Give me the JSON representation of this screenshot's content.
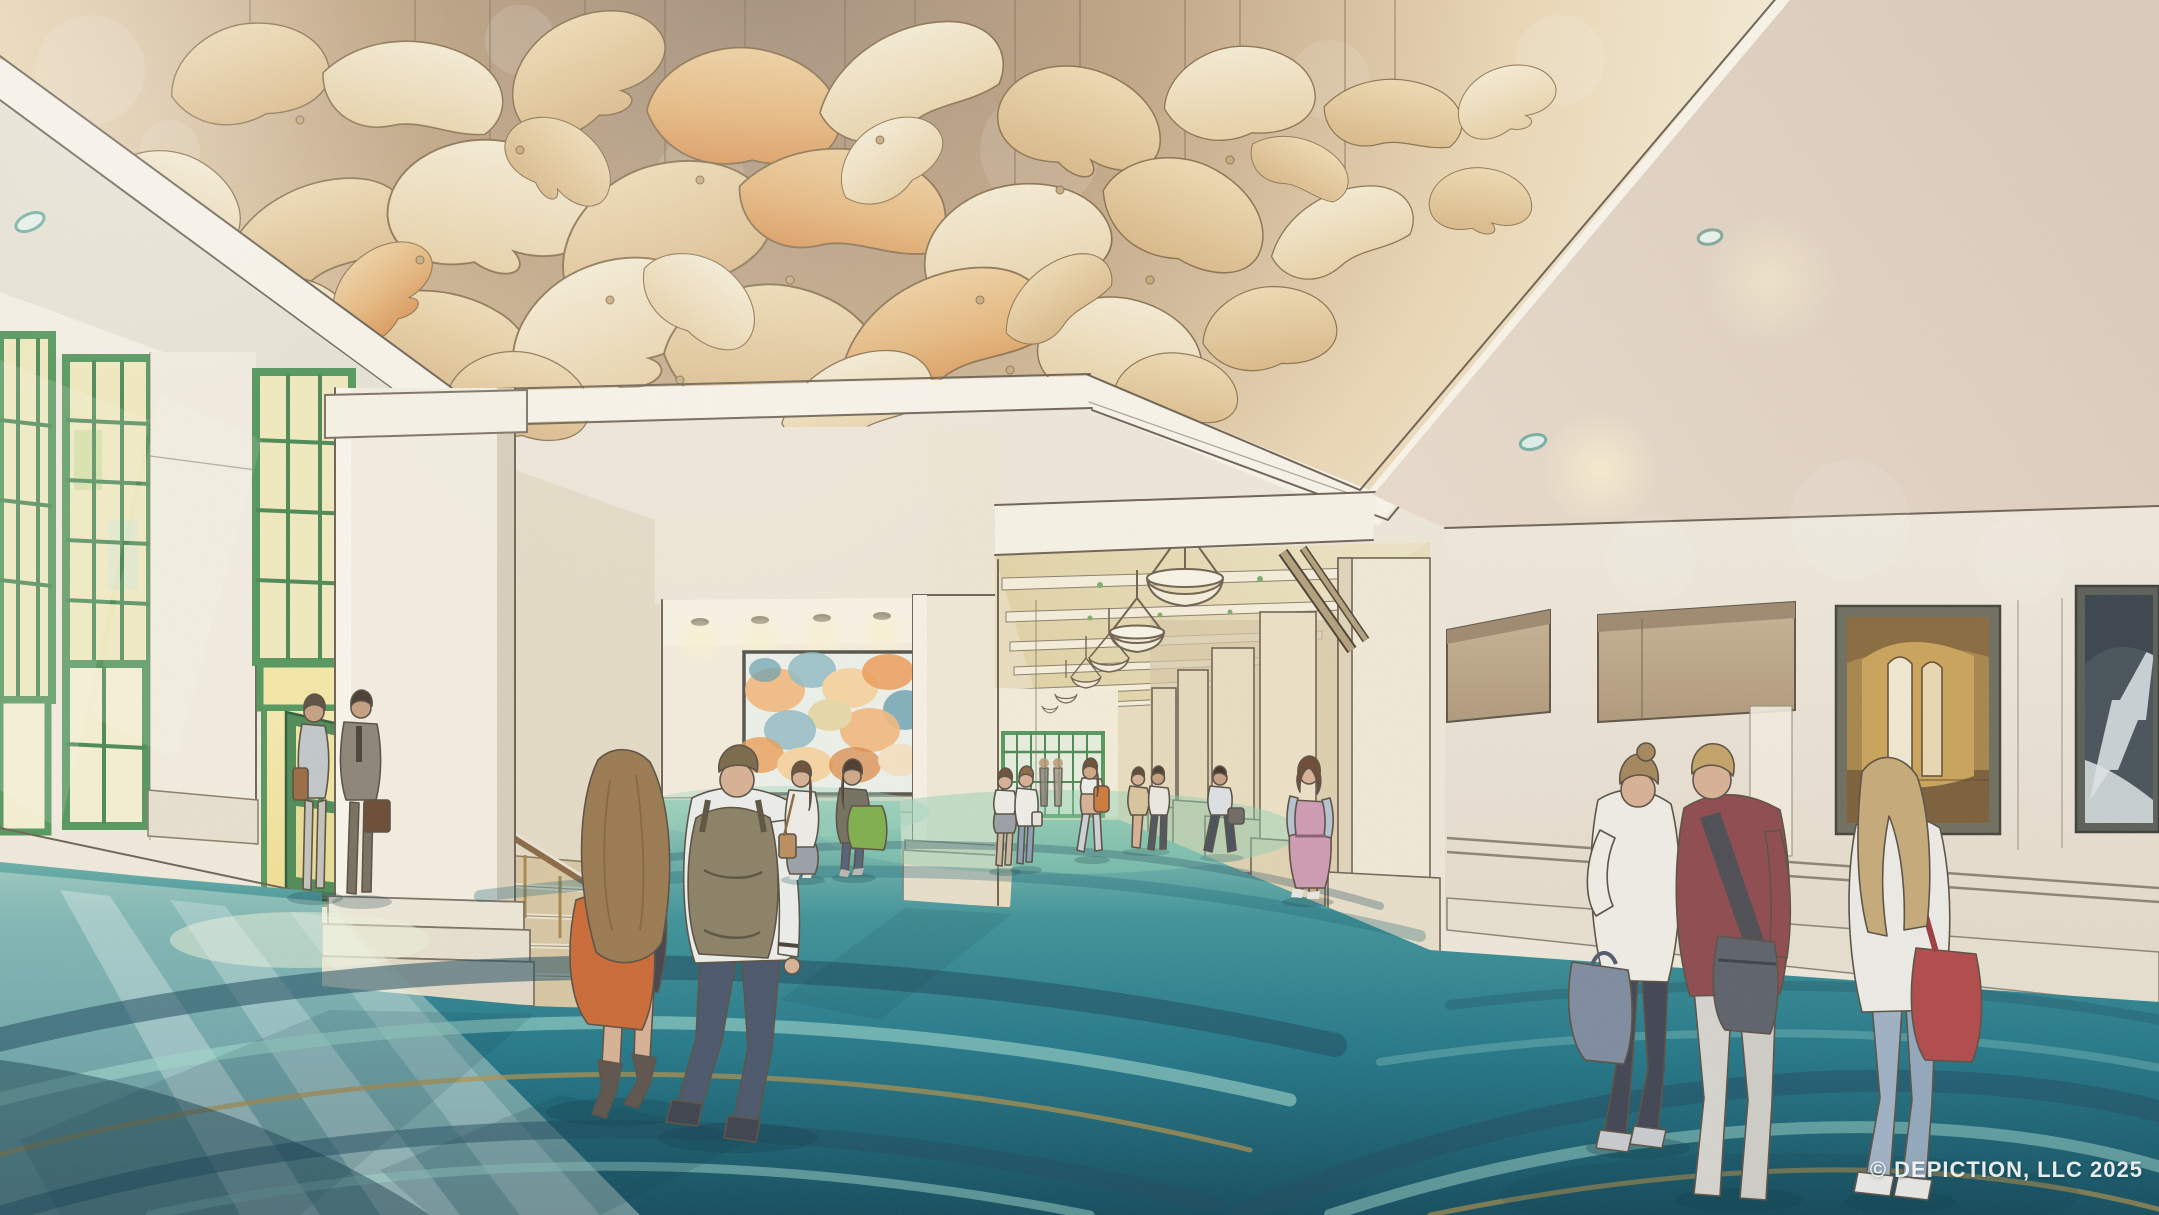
{
  "image": {
    "kind": "architectural rendering",
    "medium": "watercolor-style concept illustration",
    "subject": "convention center pre-function lobby with sculptural petal ceiling, teal swirl carpet and long pendant-lit corridor"
  },
  "watermark": {
    "text": "© DEPICTION, LLC 2025",
    "color": "#f7f7f4"
  },
  "palette": {
    "cove_brown": "#9e8a77",
    "petal_cream": "#f6eed6",
    "petal_tan": "#e5c696",
    "petal_orange": "#dd9a5c",
    "fascia_white": "#faf6ec",
    "wall_cream": "#f0eadb",
    "window_green": "#55985e",
    "glass_warm": "#f3ebc0",
    "carpet_teal": "#2e8a8e",
    "carpet_navy": "#1d4a5f",
    "carpet_aqua": "#9fd8cc",
    "carpet_gold": "#b3924a"
  },
  "scene": {
    "ceiling": {
      "installation": "dozens of suspended translucent petal-shaped panels in cream, amber and orange hung on thin wires inside a recessed cove",
      "cove": "illuminated stepped white fascia frames the cove; recessed downlights in surrounding flat ceiling"
    },
    "floor": {
      "carpet": "teal carpet with sweeping navy, aqua and gold swirl bands",
      "lighting": "sunlight pooling in from the tall windows at left"
    },
    "left_wall": {
      "windows": "tall green-framed divided-light windows with glass doors below",
      "door": "open green door with warm yellow light spilling through",
      "stair": "side stair with brass balusters, wood handrail and dark turned newel pedestal"
    },
    "center": {
      "mural": "large abstract mural in peach, orange and teal inside a lit alcove",
      "corridor": "long corridor with bowl pendant lights, coffered ceiling, colonnade of piers and green glass doors at the far end"
    },
    "right_wall": {
      "recesses": "two tan recessed entry panels",
      "artwork_1": "gold-toned painting of an arched interior",
      "artwork_2": "dark blue-gray painting of a staircase",
      "details": "chair rail and baseboard moldings"
    },
    "people": [
      {
        "id": "door-woman",
        "description": "woman in light cardigan with brown bag entering at open door"
      },
      {
        "id": "door-man",
        "description": "man in gray suit with glasses and brown briefcase"
      },
      {
        "id": "foreground-woman",
        "description": "woman with long brown hair, dark dress, orange tote and heeled boots, walking away"
      },
      {
        "id": "foreground-man",
        "description": "man in white shirt with olive backpack and dark jeans, walking away"
      },
      {
        "id": "mural-woman-1",
        "description": "woman in white top with tan crossbody bag viewing the mural"
      },
      {
        "id": "mural-woman-2",
        "description": "woman in dark jacket with bright green tote viewing the mural"
      },
      {
        "id": "corridor-woman-1",
        "description": "woman in white top and gray skirt chatting in corridor"
      },
      {
        "id": "corridor-woman-2",
        "description": "woman in white top and jeans with white handbag"
      },
      {
        "id": "orange-backpack-woman",
        "description": "walking woman with orange backpack and light pants"
      },
      {
        "id": "distant-couple",
        "description": "couple walking near the colonnade"
      },
      {
        "id": "distant-man",
        "description": "man walking with gray duffel bag"
      },
      {
        "id": "pink-dress-woman",
        "description": "woman with brown bob in rose pinafore dress over light blue shirt"
      },
      {
        "id": "trio-woman-bun",
        "description": "woman with hair bun, white blouse, navy pants and blue-gray handbag"
      },
      {
        "id": "trio-man",
        "description": "man in maroon shirt with gray messenger bag and light pants"
      },
      {
        "id": "trio-woman-blonde",
        "description": "blonde woman in white top, light jeans, red shoulder bag"
      }
    ]
  }
}
